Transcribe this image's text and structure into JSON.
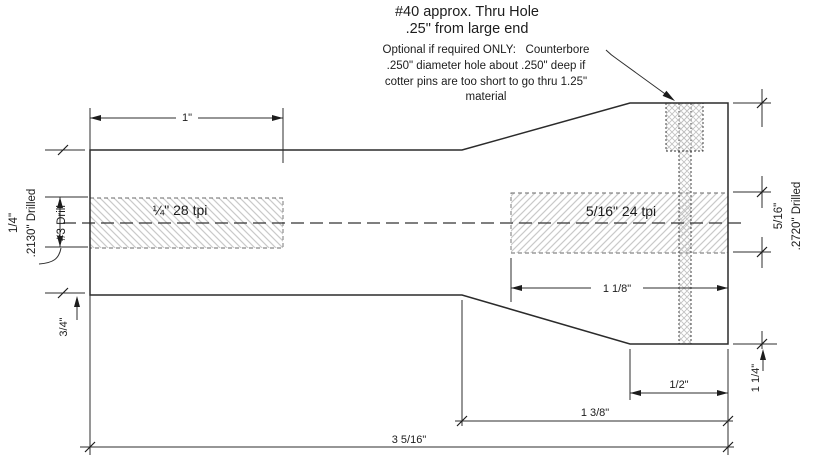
{
  "drawing": {
    "background_color": "#ffffff",
    "line_color": "#2b2b2b",
    "hatch_color": "#c9c9c9"
  },
  "annotations": {
    "title_line1": "#40 approx. Thru Hole",
    "title_line2": ".25\" from large end",
    "note_line1": "Optional if required ONLY:   Counterbore",
    "note_line2": ".250\" diameter hole about .250\" deep if",
    "note_line3": "cotter pins are too short to go thru 1.25\"",
    "note_line4": "material"
  },
  "thread_labels": {
    "left": "¼\" 28 tpi",
    "right": "5/16\" 24 tpi"
  },
  "left_hole_label": {
    "size": "1/4\"",
    "drill": ".2130\" Drilled",
    "bit": "#3 Drill"
  },
  "right_hole_label": {
    "size": "5/16\"",
    "drill": ".2720\" Drilled",
    "bit": "Letter size I"
  },
  "dimensions": {
    "left_thread_length": "1\"",
    "right_thread_length": "1 1/8\"",
    "small_end_diameter": "3/4\"",
    "large_end_diameter": "1 1/4\"",
    "step_length": "1/2\"",
    "large_section_length": "1 3/8\"",
    "overall_length": "3 5/16\""
  }
}
